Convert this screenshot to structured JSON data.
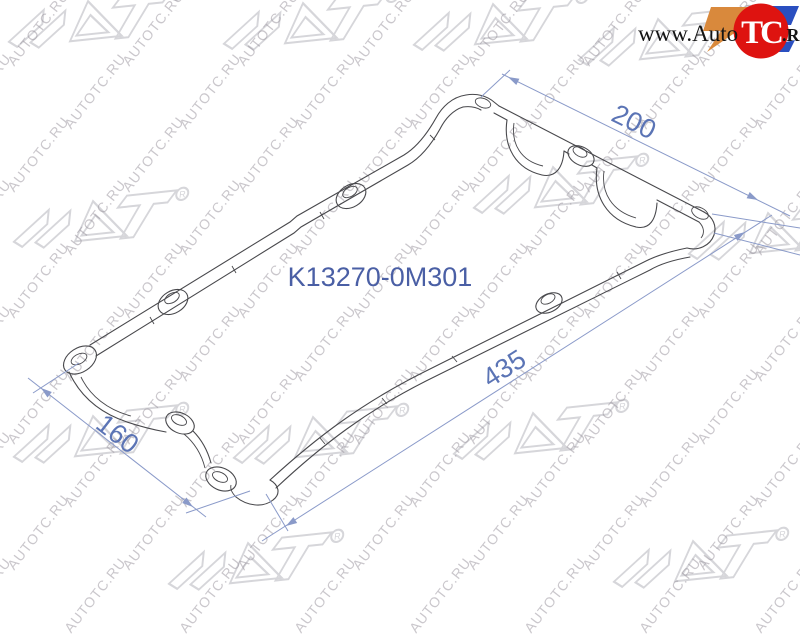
{
  "part_number": "K13270-0M301",
  "dimensions": {
    "top": {
      "value": "200"
    },
    "diagonal": {
      "value": "435"
    },
    "left": {
      "value": "160"
    }
  },
  "watermark": {
    "text": "AUTOTC.RU",
    "brand": "SAT",
    "registered": "R"
  },
  "logo": {
    "prefix": "www.Auto",
    "badge": "TC",
    "suffix": ".RU"
  },
  "colors": {
    "dimension_line": "#8a9ac9",
    "dimension_text": "#5b74b5",
    "part_number_text": "#4a5fa5",
    "drawing_ink": "#48484c",
    "logo_red": "#de1310",
    "logo_orange": "#d9893c",
    "logo_blue": "#2a4fc0"
  }
}
